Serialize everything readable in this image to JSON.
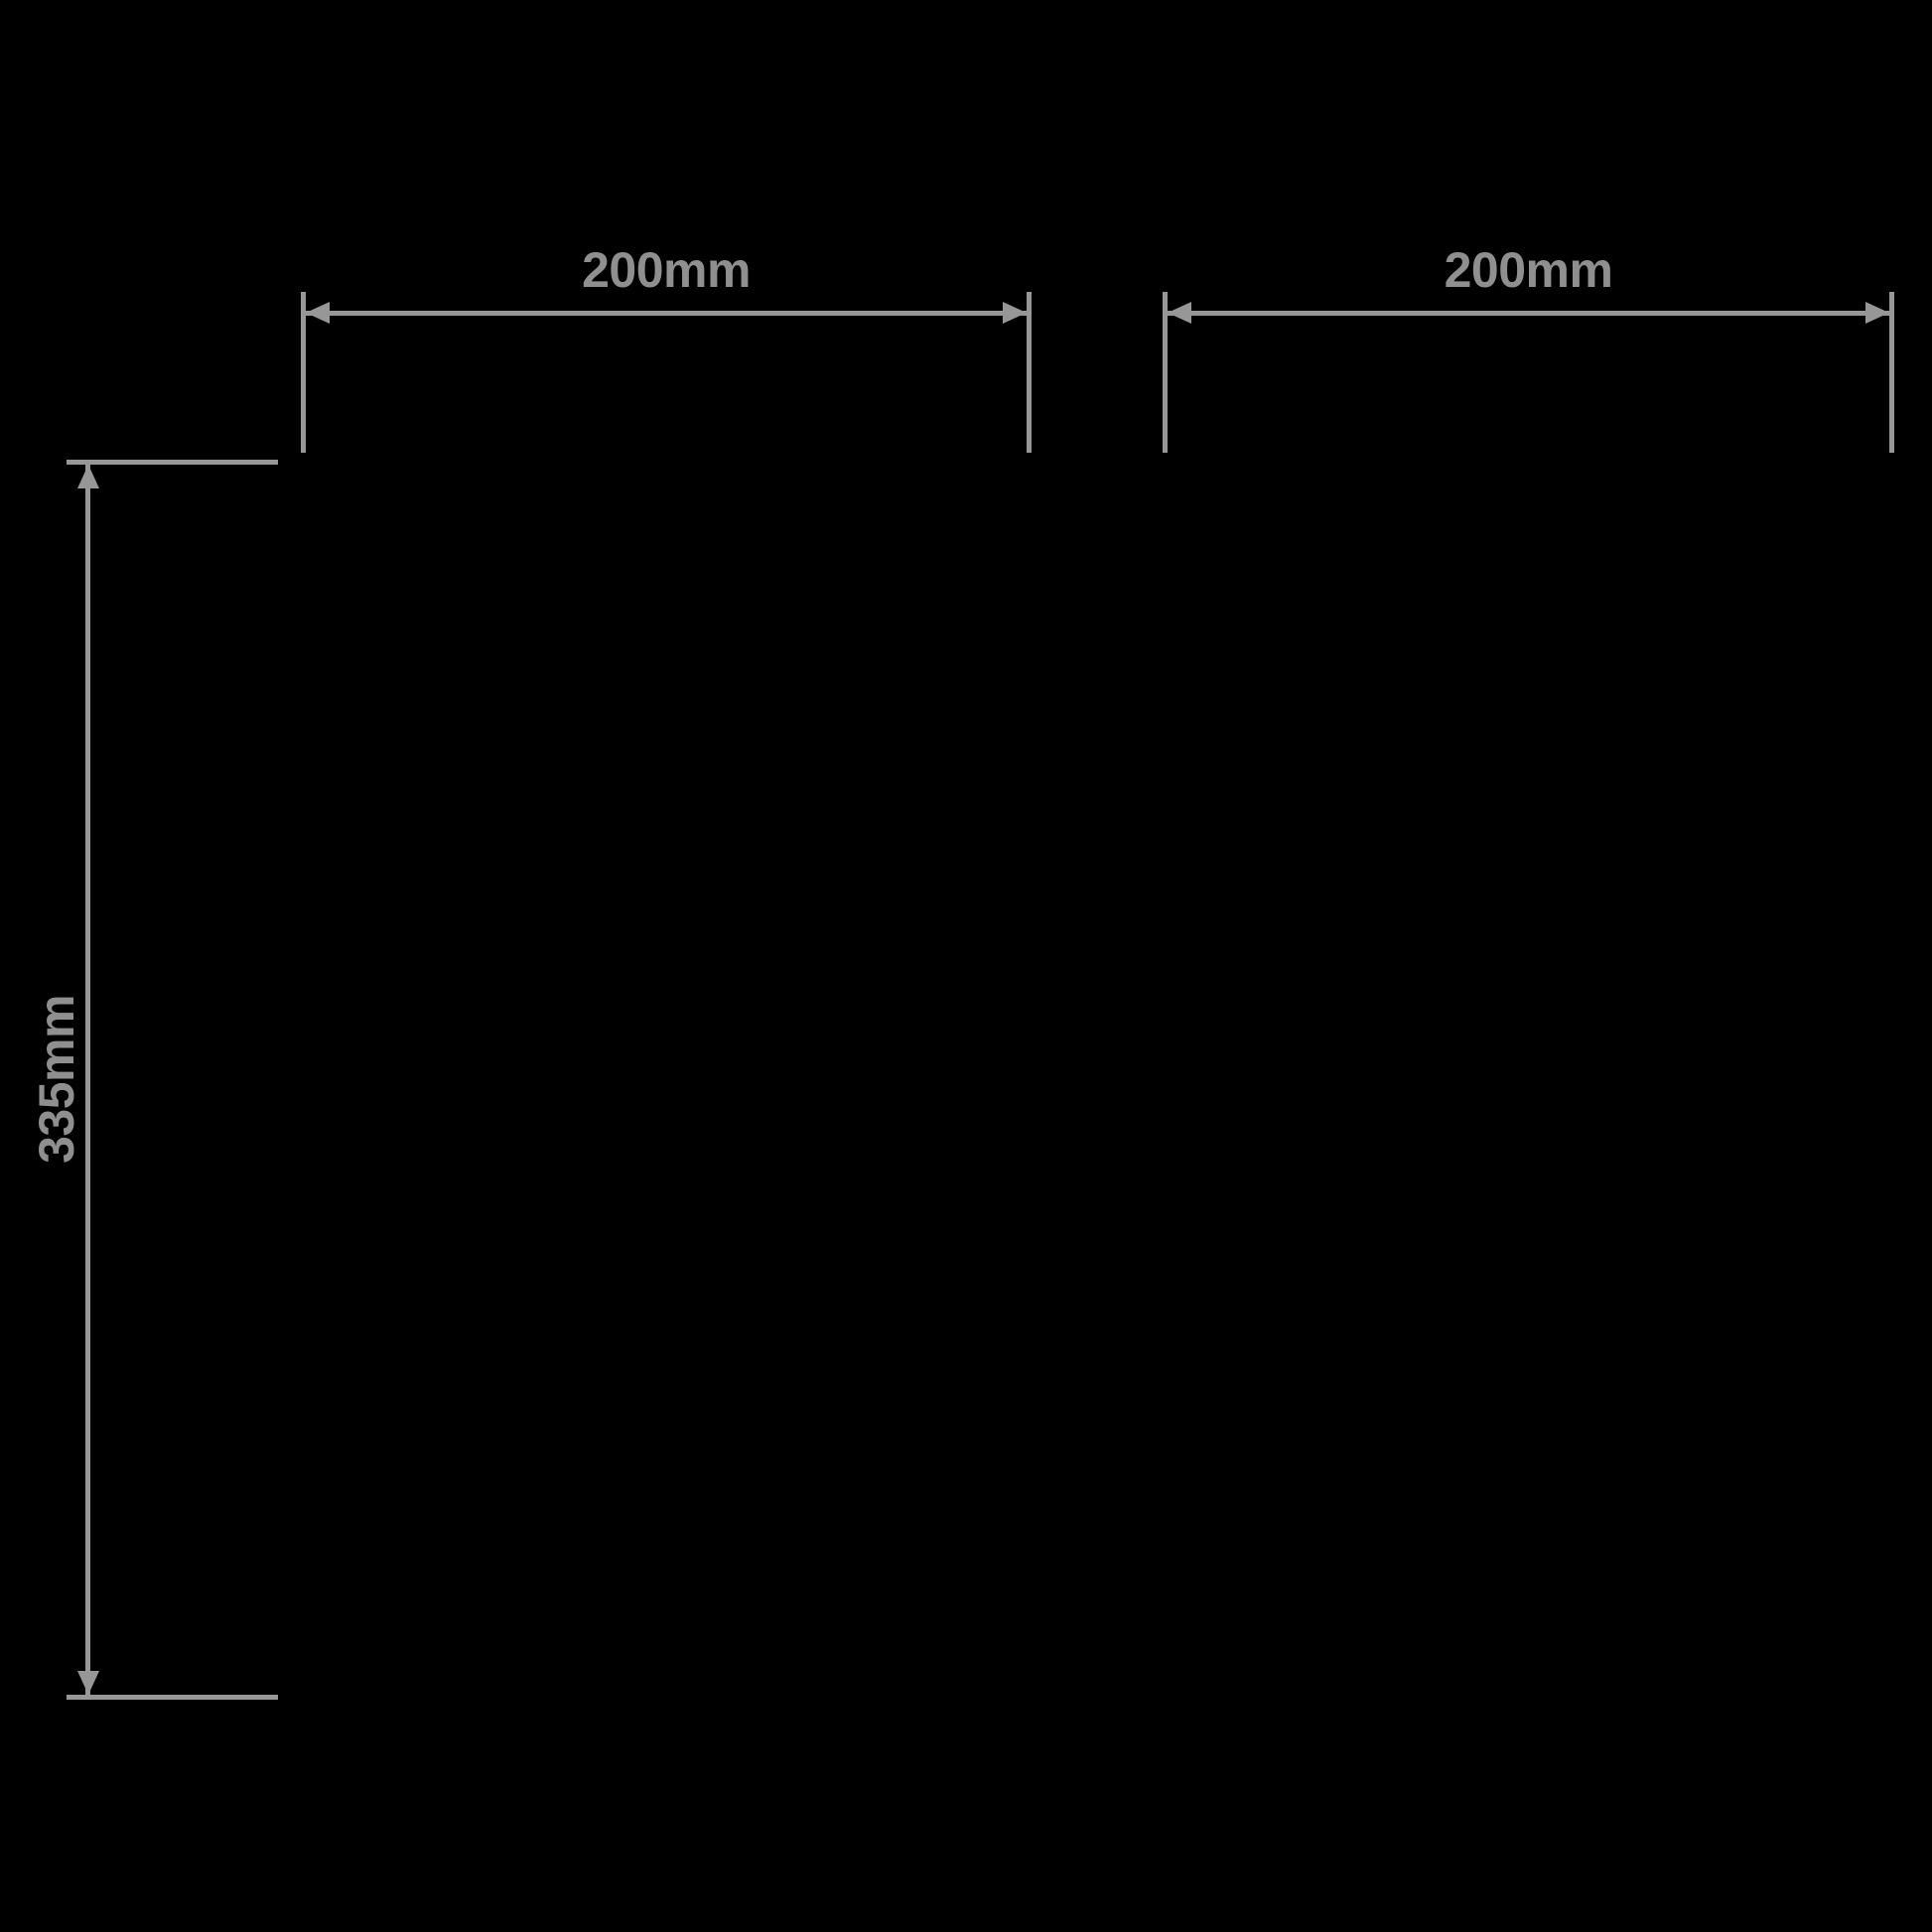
{
  "colors": {
    "background": "#000000",
    "line": "#979797",
    "text": "#8f8f8f"
  },
  "diagram": {
    "kind": "product-dimension-diagram"
  },
  "dimensions": {
    "width_left": {
      "label": "200mm",
      "value": 200,
      "unit": "mm",
      "orientation": "horizontal"
    },
    "width_right": {
      "label": "200mm",
      "value": 200,
      "unit": "mm",
      "orientation": "horizontal"
    },
    "height": {
      "label": "335mm",
      "value": 335,
      "unit": "mm",
      "orientation": "vertical"
    }
  }
}
